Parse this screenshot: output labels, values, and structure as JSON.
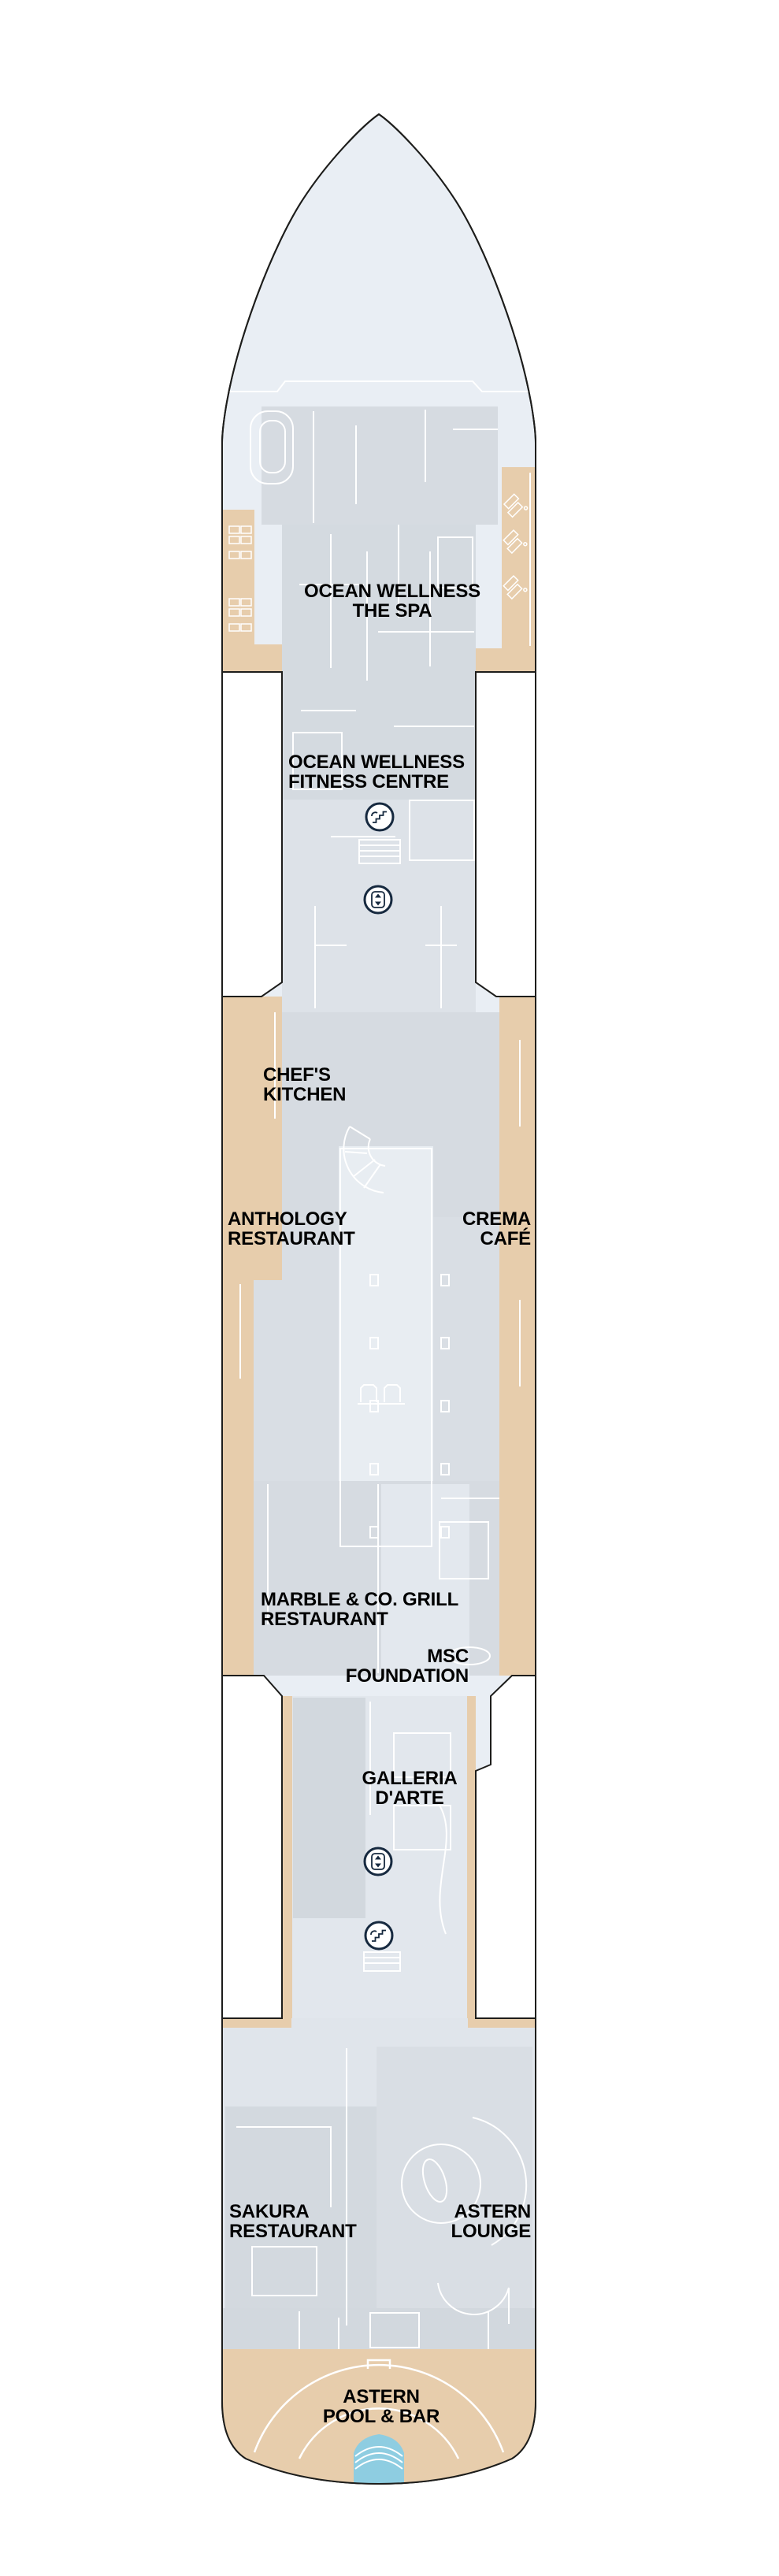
{
  "plan": {
    "labels": {
      "spa": {
        "line1": "OCEAN WELLNESS",
        "line2": "THE SPA"
      },
      "fitness": {
        "line1": "OCEAN WELLNESS",
        "line2": "FITNESS CENTRE"
      },
      "chefs_kitchen": {
        "line1": "CHEF'S",
        "line2": "KITCHEN"
      },
      "anthology": {
        "line1": "ANTHOLOGY",
        "line2": "RESTAURANT"
      },
      "crema_cafe": {
        "line1": "CREMA",
        "line2": "CAFÉ"
      },
      "marble_grill": {
        "line1": "MARBLE & CO. GRILL",
        "line2": "RESTAURANT"
      },
      "msc_foundation": {
        "line1": "MSC",
        "line2": "FOUNDATION"
      },
      "galleria_darte": {
        "line1": "GALLERIA",
        "line2": "D'ARTE"
      },
      "sakura": {
        "line1": "SAKURA",
        "line2": "RESTAURANT"
      },
      "astern_lounge": {
        "line1": "ASTERN",
        "line2": "LOUNGE"
      },
      "astern_pool": {
        "line1": "ASTERN",
        "line2": "POOL & BAR"
      }
    },
    "icons": {
      "stairs": "stairs-icon",
      "elevator": "elevator-icon"
    },
    "colors": {
      "hull_fill": "#e9eef4",
      "room_gray": "#d4dae0",
      "promenade_tan": "#e7cdac",
      "pool_blue": "#8ecde1",
      "outline": "#1d1d1b",
      "icon_navy": "#16293f",
      "wall_white": "#ffffff"
    }
  }
}
